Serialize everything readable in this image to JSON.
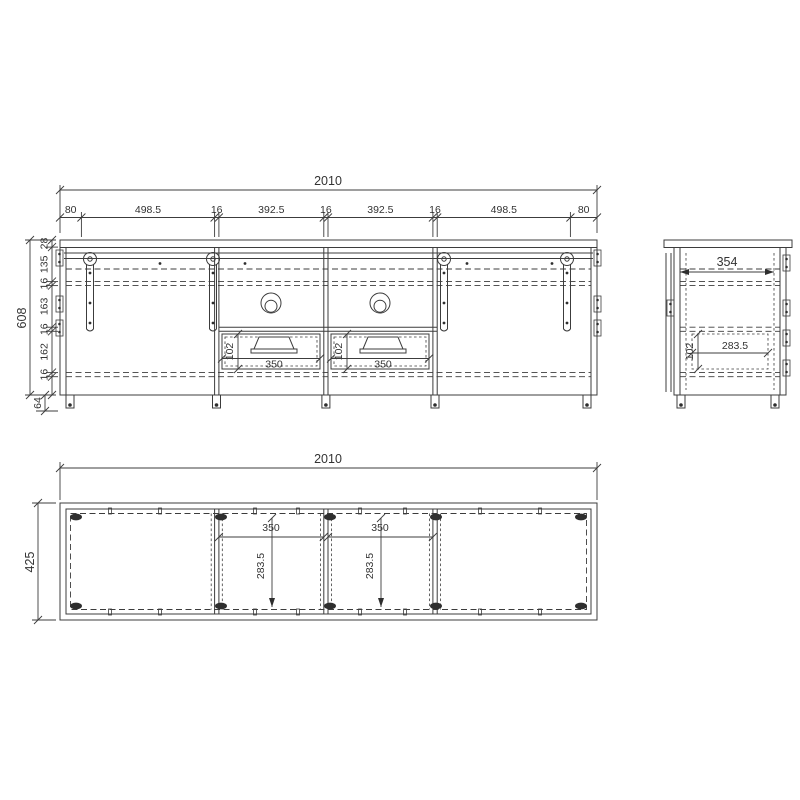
{
  "front": {
    "total_width": "2010",
    "width_chain": [
      "80",
      "498.5",
      "16",
      "392.5",
      "16",
      "392.5",
      "16",
      "498.5",
      "80"
    ],
    "total_height": "608",
    "height_chain": [
      "28",
      "135",
      "16",
      "163",
      "16",
      "162",
      "16"
    ],
    "feet_height": "64",
    "drawer_height": "102",
    "drawer_width": "350"
  },
  "side": {
    "inner_depth": "354",
    "drawer_depth": "283.5",
    "drawer_height": "102"
  },
  "bottom": {
    "total_width": "2010",
    "total_depth": "425",
    "compartment_width": "350",
    "compartment_depth": "283.5"
  }
}
